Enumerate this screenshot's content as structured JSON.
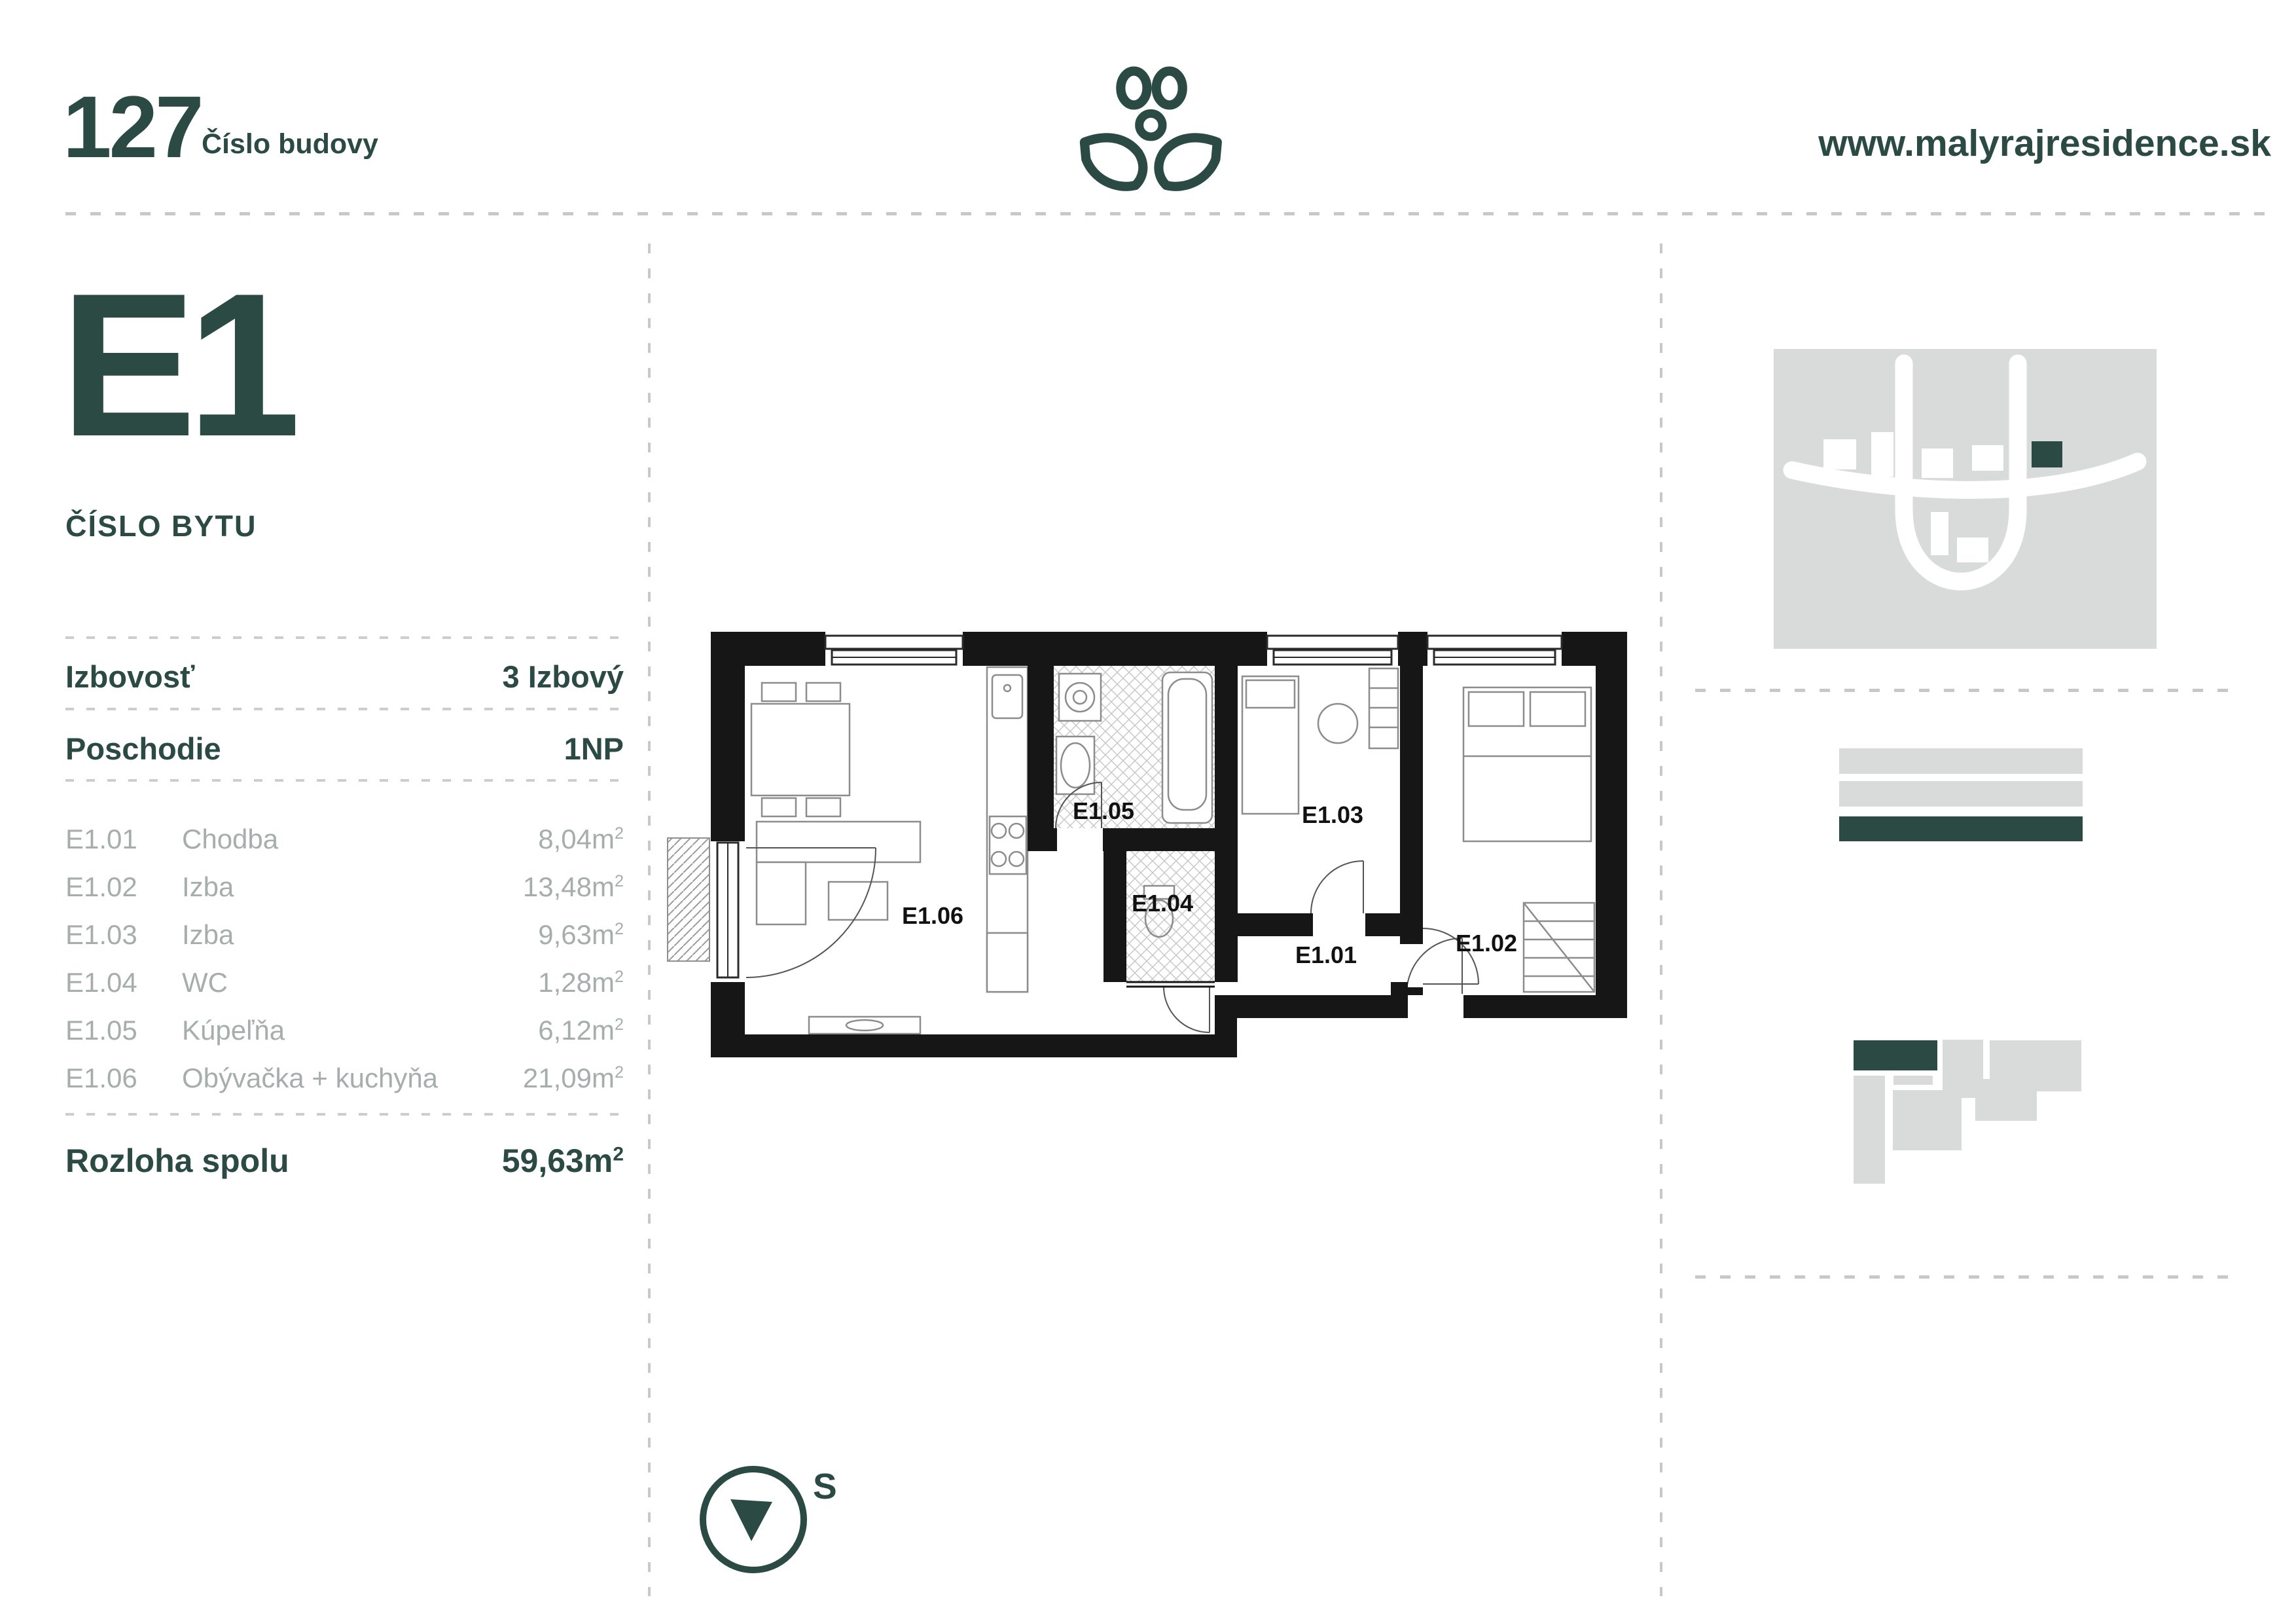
{
  "colors": {
    "accent_dark_green": "#2C4A44",
    "muted_gray_text": "#A6AEAD",
    "light_gray_fill": "#D9DADA",
    "dash_line_gray": "#C6C9C8",
    "plan_wall_black": "#161616"
  },
  "header": {
    "building_number": "127",
    "building_number_label": "Číslo budovy",
    "website": "www.malyrajresidence.sk",
    "logo_icon": "plant-logo"
  },
  "apartment": {
    "number": "E1",
    "number_label": "ČÍSLO BYTU"
  },
  "details": [
    {
      "label": "Izbovosť",
      "value": "3 Izbový"
    },
    {
      "label": "Poschodie",
      "value": "1NP"
    }
  ],
  "rooms": {
    "unit_base": "m",
    "unit_sup": "2",
    "items": [
      {
        "code": "E1.01",
        "name": "Chodba",
        "area": "8,04"
      },
      {
        "code": "E1.02",
        "name": "Izba",
        "area": "13,48"
      },
      {
        "code": "E1.03",
        "name": "Izba",
        "area": "9,63"
      },
      {
        "code": "E1.04",
        "name": "WC",
        "area": "1,28"
      },
      {
        "code": "E1.05",
        "name": "Kúpeľňa",
        "area": "6,12"
      },
      {
        "code": "E1.06",
        "name": "Obývačka + kuchyňa",
        "area": "21,09"
      }
    ],
    "total_label": "Rozloha spolu",
    "total_area": "59,63"
  },
  "floor_plan": {
    "rooms": {
      "e101": "E1.01",
      "e102": "E1.02",
      "e103": "E1.03",
      "e104": "E1.04",
      "e105": "E1.05",
      "e106": "E1.06"
    }
  },
  "compass": {
    "label": "S",
    "icon": "compass-south-icon"
  },
  "site_map": {
    "icon": "site-plan-map",
    "highlight_building_icon": "current-building-marker"
  },
  "legend_bars": {
    "icon": "floor-level-bars",
    "highlight": "current-floor-bar"
  },
  "building_layout": {
    "icon": "building-units-diagram",
    "highlight": "current-unit-marker"
  }
}
